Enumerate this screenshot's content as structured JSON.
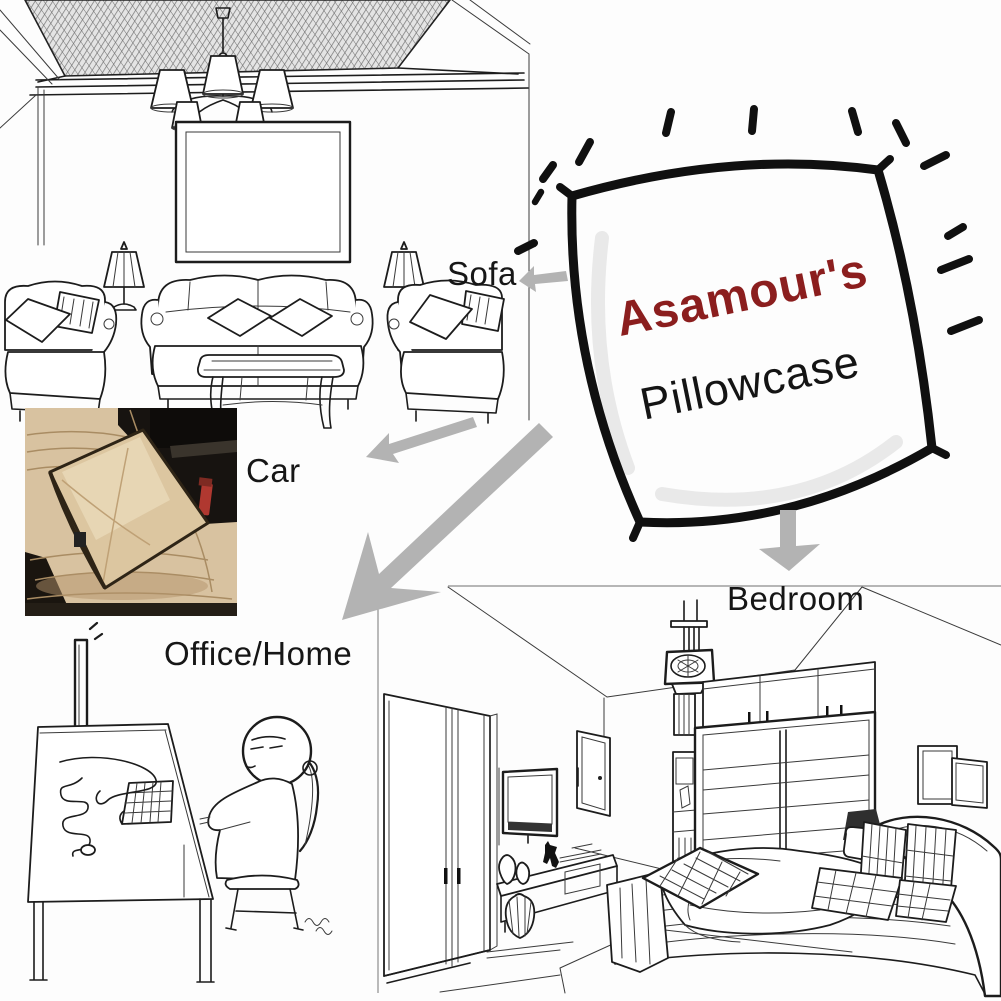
{
  "diagram": {
    "product": {
      "brand": "Asamour's",
      "name": "Pillowcase"
    },
    "labels": {
      "sofa": "Sofa",
      "car": "Car",
      "office_home": "Office/Home",
      "bedroom": "Bedroom"
    },
    "colors": {
      "brand_text": "#8b1e1e",
      "product_text": "#141414",
      "label_text": "#161616",
      "arrow_gray": "#b3b3b3",
      "sketch_line": "#1c1c1c",
      "car_seat_beige": "#d8c2a0",
      "car_pillow_tan": "#dcc6a0",
      "car_dark_bg": "#171310",
      "car_buckle_red": "#b03830"
    },
    "icons": {
      "sofa_arrow": "left-arrow-icon",
      "car_arrow": "down-left-arrow-icon",
      "office_arrow": "big-down-left-arrow-icon",
      "bedroom_arrow": "down-arrow-icon",
      "sparkles": "radiating-dashes-icon"
    }
  }
}
